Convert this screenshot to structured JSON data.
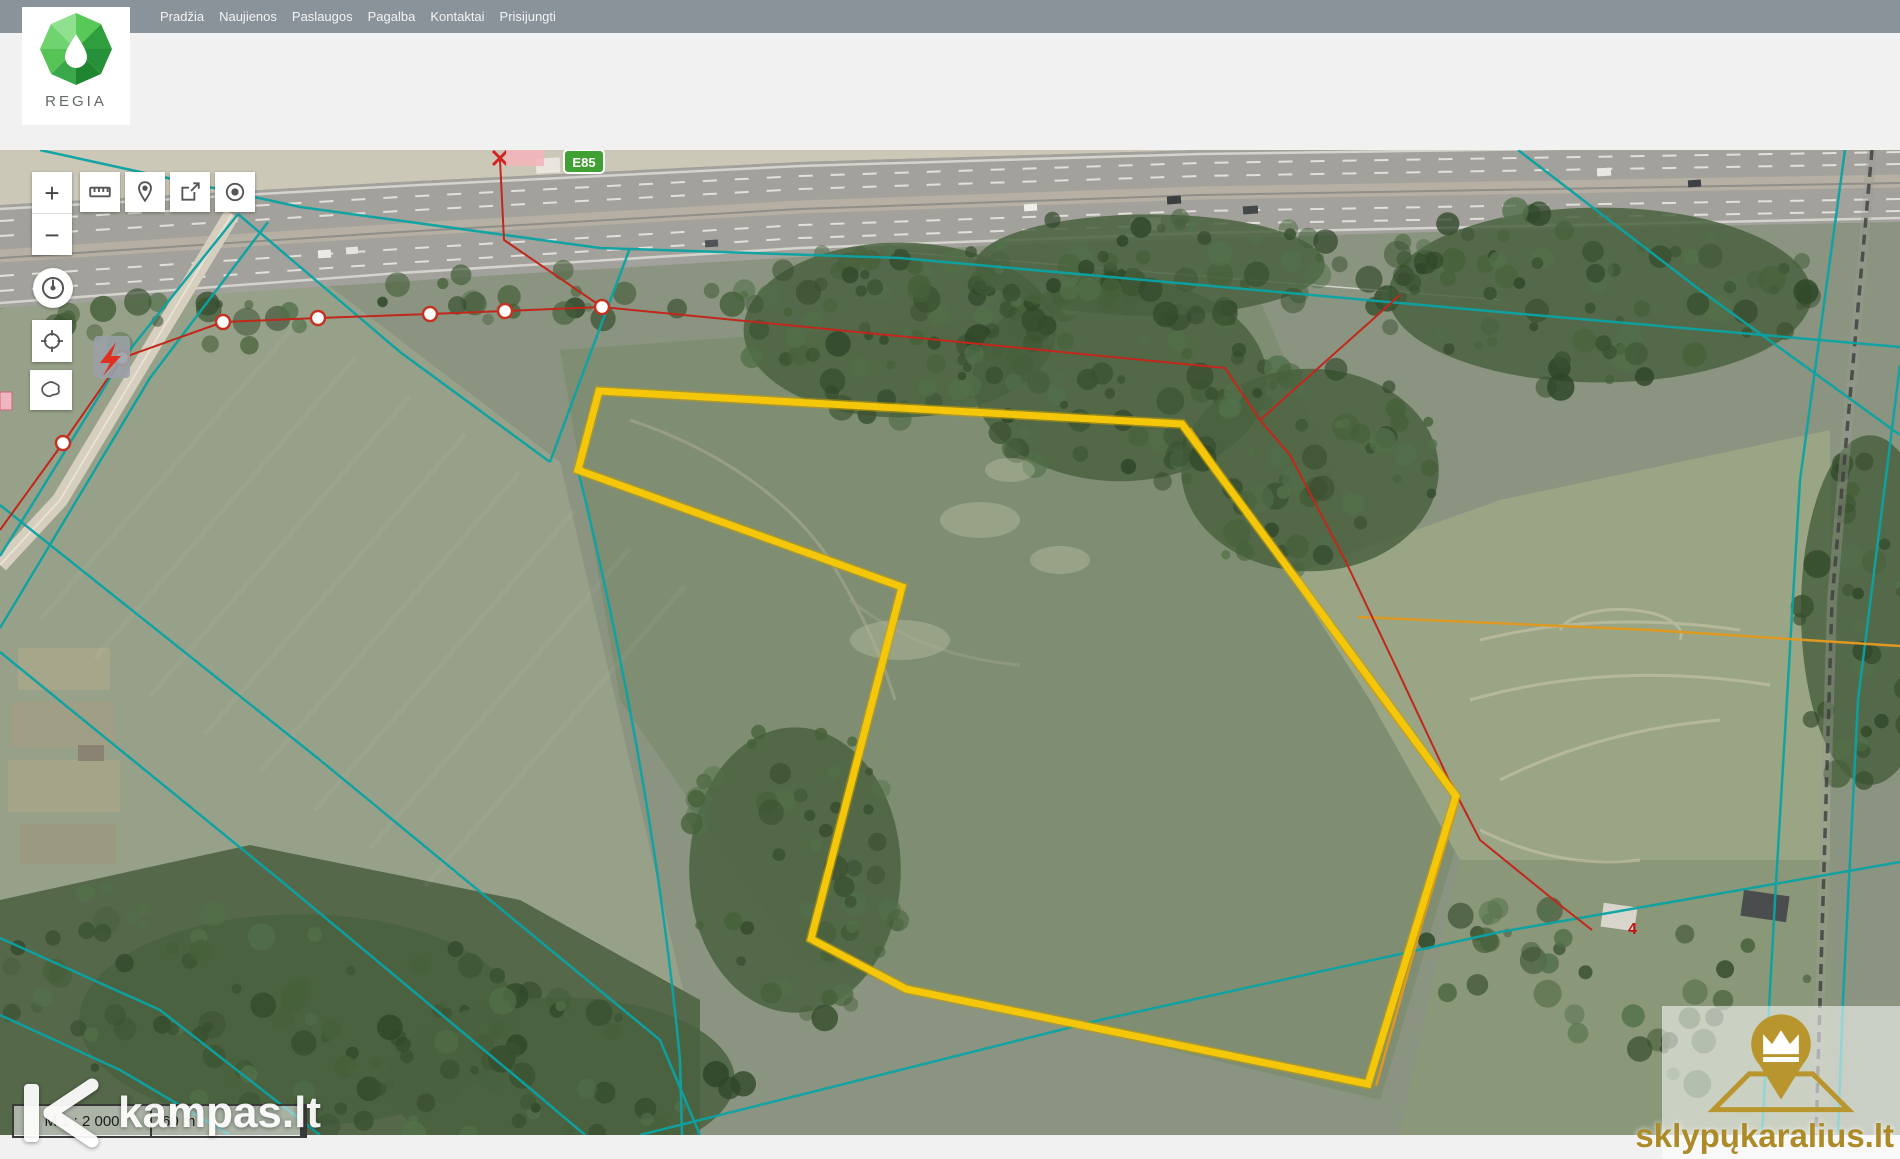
{
  "nav": {
    "items": [
      "Pradžia",
      "Naujienos",
      "Paslaugos",
      "Pagalba",
      "Kontaktai",
      "Prisijungti"
    ]
  },
  "brand": {
    "name": "REGIA"
  },
  "map_controls": {
    "zoom_in": "+",
    "zoom_out": "−",
    "tools": [
      "measure",
      "marker",
      "share",
      "locate",
      "history",
      "crosshair",
      "lithuania-extent"
    ]
  },
  "map": {
    "road_sign": "E85",
    "house_number": "4",
    "scale": {
      "ratio": "M 1 : 2 000",
      "bar": "60 m"
    }
  },
  "watermarks": {
    "left": "kampas.lt",
    "right": "sklypųkaralius.lt"
  },
  "colors": {
    "parcel_highlight": "#f4c70a",
    "cadastral_teal": "#0ba3a3",
    "power_line_red": "#c1271b",
    "boundary_orange": "#dd9922",
    "brand_green": "#3aa84a",
    "navbar_gray": "#8b939a",
    "watermark_gold": "#ac8b28"
  }
}
